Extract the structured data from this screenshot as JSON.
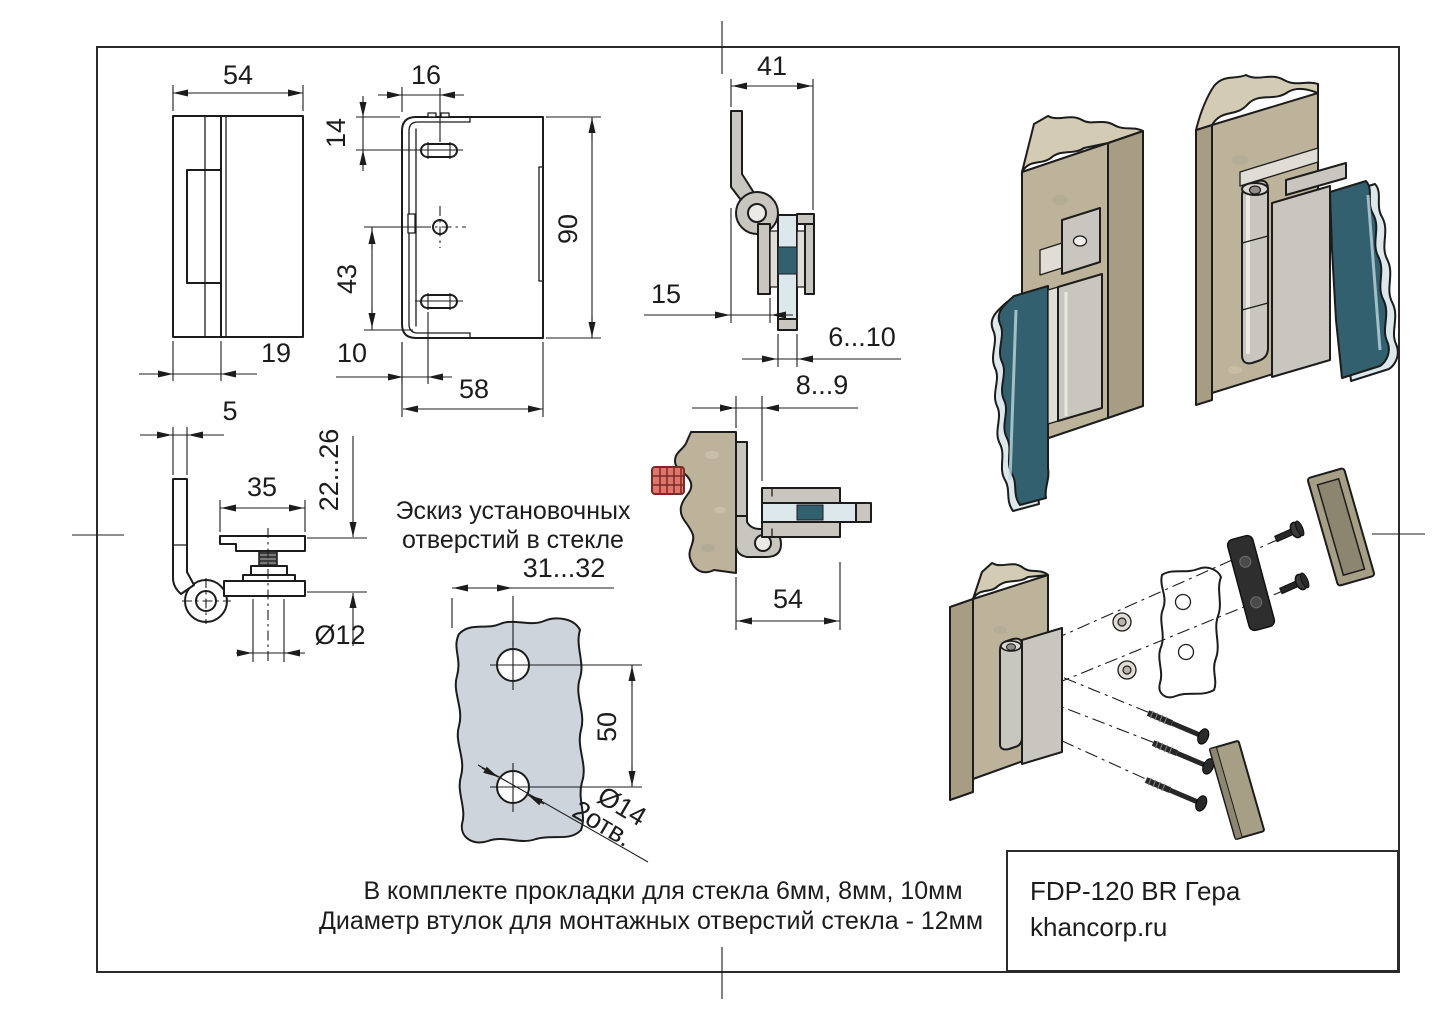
{
  "colors": {
    "line": "#1c1c1c",
    "wood": "#bdb39a",
    "wood_side": "#a79c84",
    "wood_top": "#d3cbb3",
    "metal": "#c9c6bf",
    "metal_light": "#dfddd6",
    "glass_dark": "#33606f",
    "glass_light": "#dce8ec",
    "glass_sketch": "#ced4db",
    "gasket_dark": "#2e2e2e",
    "cap_khaki": "#a69f86",
    "cap_khaki_dark": "#8c8670",
    "screw_red": "#e0766d",
    "screw_black": "#262626"
  },
  "title_block": {
    "product": "FDP-120 BR Гера",
    "website": "khancorp.ru"
  },
  "notes": {
    "line1": "В комплекте прокладки для стекла 6мм, 8мм, 10мм",
    "line2": "Диаметр втулок для монтажных отверстий стекла - 12мм"
  },
  "glass_sketch": {
    "title_line1": "Эскиз установочных",
    "title_line2": "отверстий в стекле",
    "hole_offset": "31...32",
    "hole_spacing": "50",
    "hole_diameter": "Ø14",
    "hole_count_label": "2отв."
  },
  "dimensions": {
    "front_width": "54",
    "leaf_width": "19",
    "leaf_thickness": "5",
    "plate_hole_offset": "16",
    "plate_slot_offset_top": "14",
    "plate_hole_to_bottom": "43",
    "plate_slot_offset_left": "10",
    "plate_width": "58",
    "plate_height": "90",
    "side_depth": "41",
    "leaf_to_clamp": "15",
    "glass_thickness_range": "6...10",
    "wood_to_glass_gap": "8...9",
    "clamp_length": "54",
    "clamp_pad_width": "35",
    "clamp_height_range": "22...26",
    "bushing_diameter": "Ø12"
  }
}
